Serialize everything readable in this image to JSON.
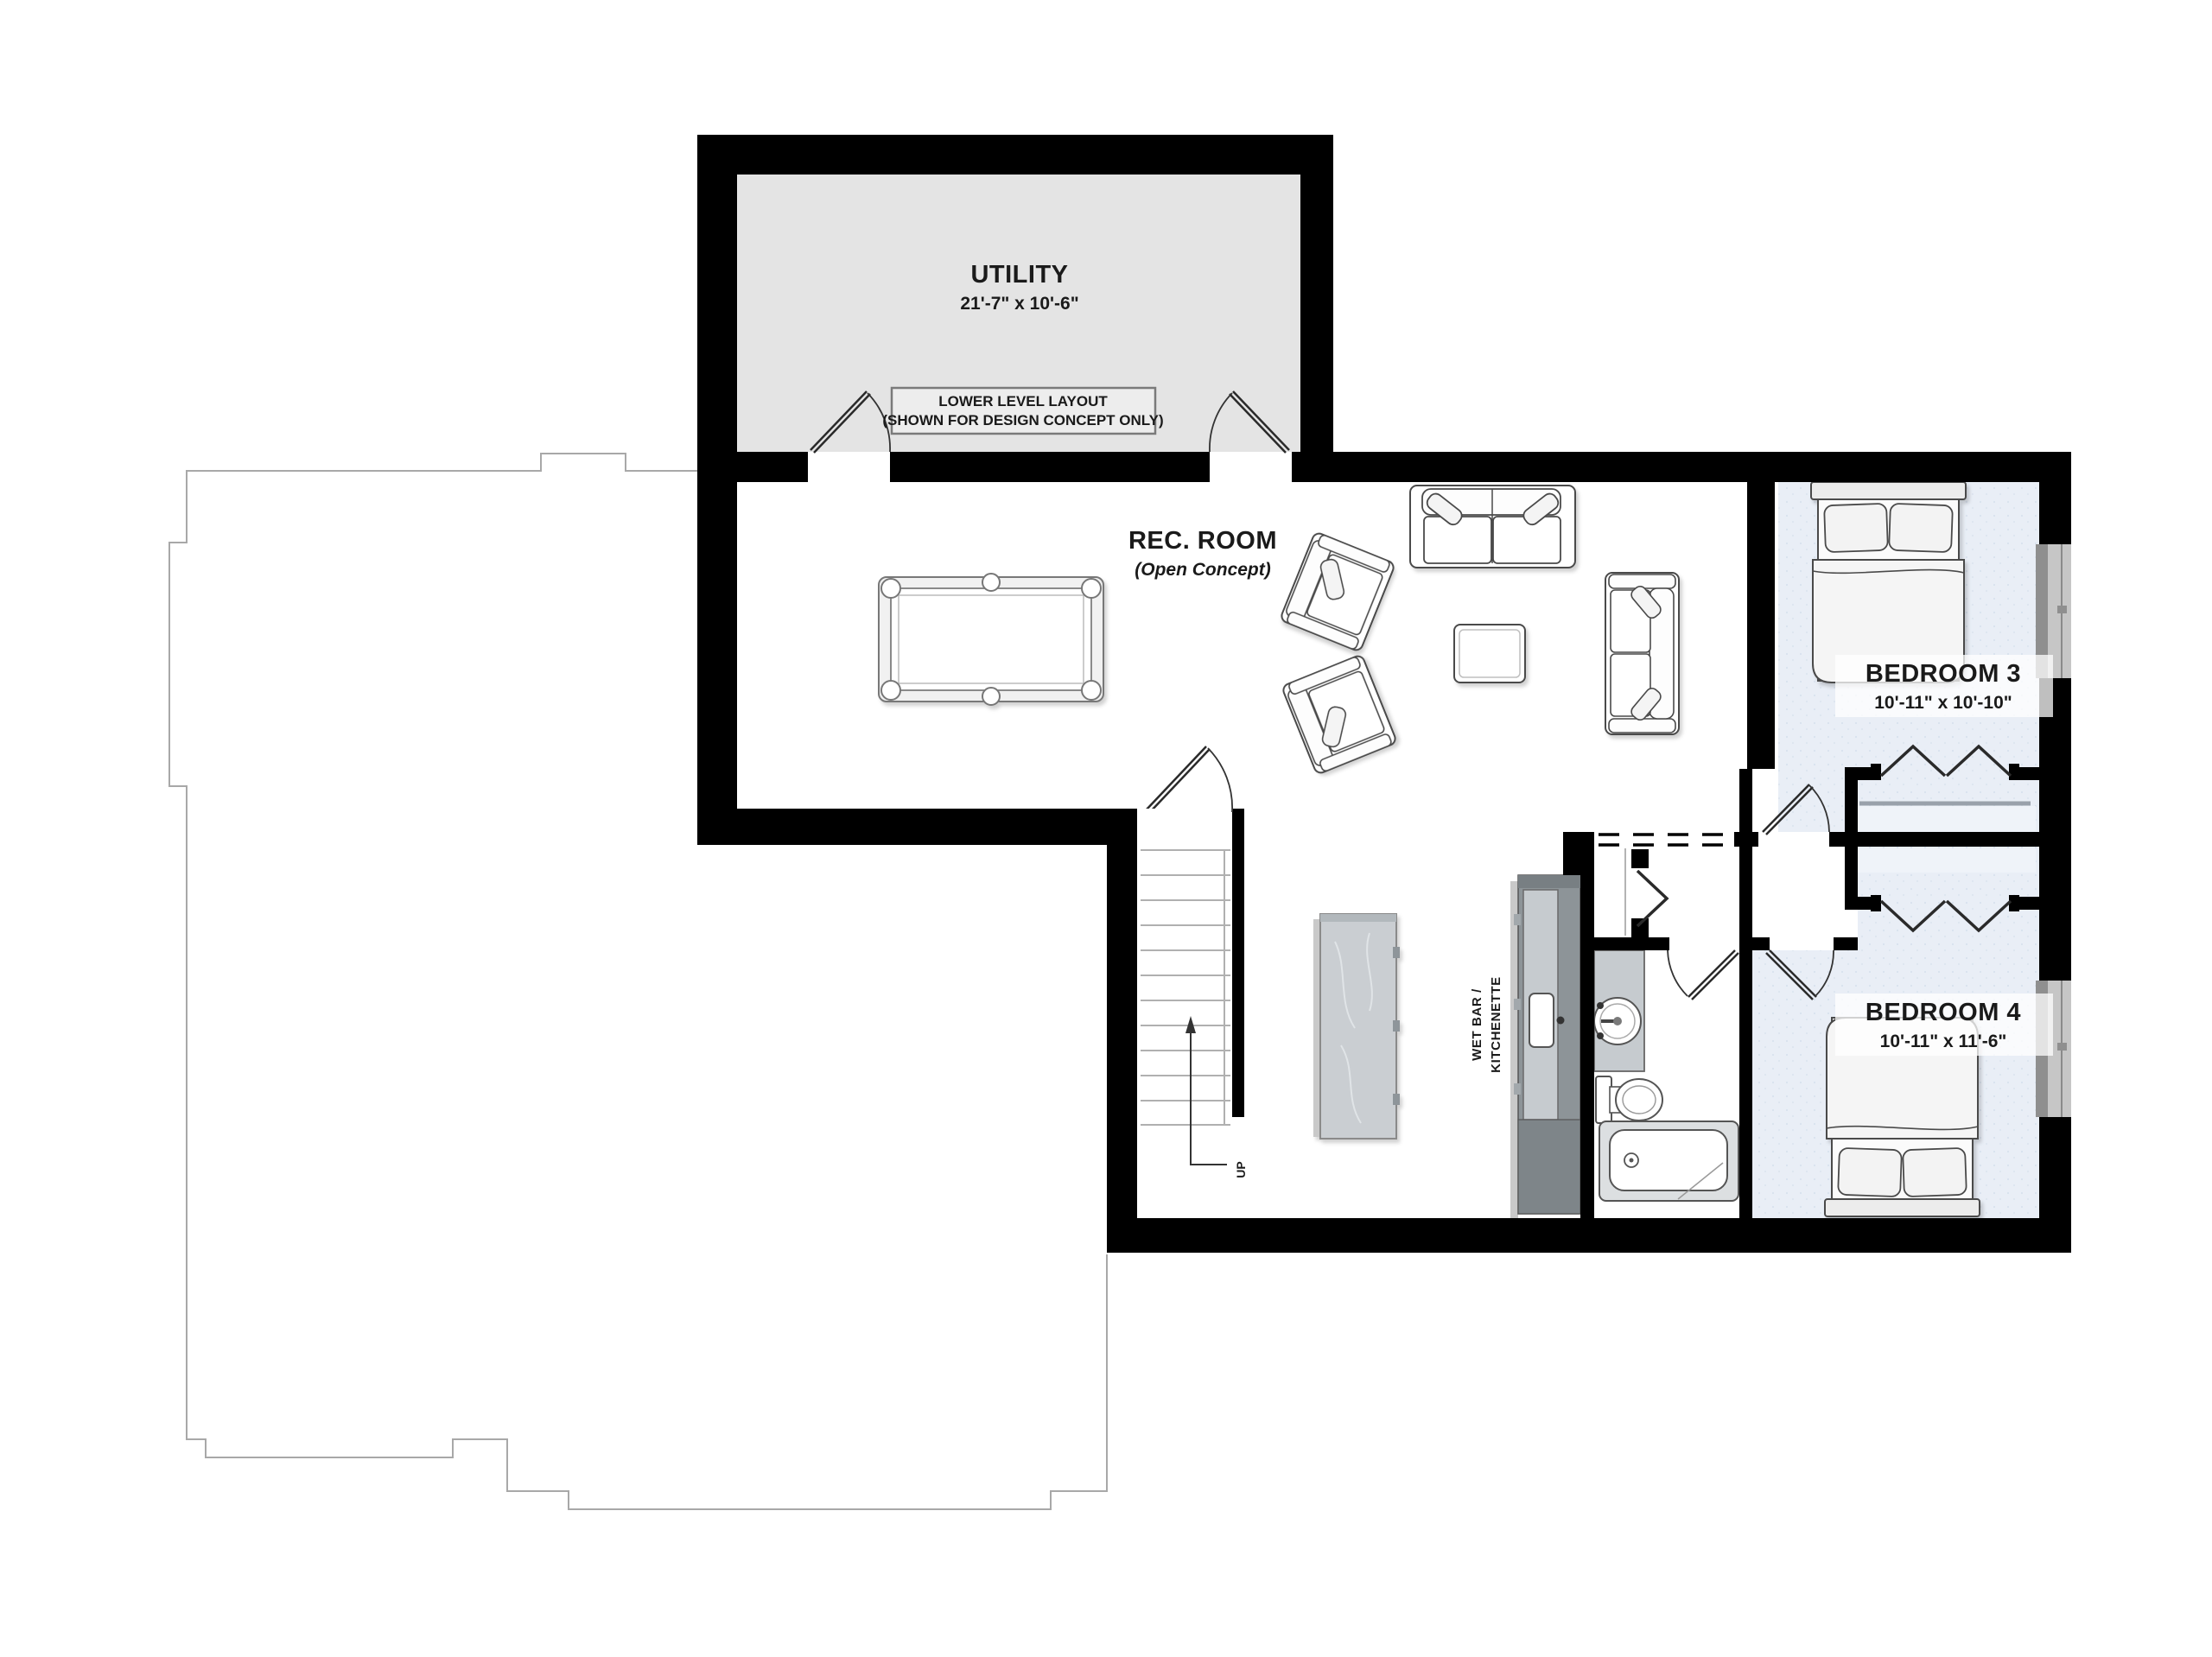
{
  "rooms": {
    "utility": {
      "name": "UTILITY",
      "dims": "21'-7\" x 10'-6\""
    },
    "rec_room": {
      "name": "REC. ROOM",
      "sub": "(Open Concept)"
    },
    "bedroom3": {
      "name": "BEDROOM 3",
      "dims": "10'-11\" x 10'-10\""
    },
    "bedroom4": {
      "name": "BEDROOM 4",
      "dims": "10'-11\" x 11'-6\""
    },
    "wet_bar": {
      "line1": "WET BAR /",
      "line2": "KITCHENETTE"
    }
  },
  "disclaimer": {
    "line1": "LOWER LEVEL LAYOUT",
    "line2": "(SHOWN FOR DESIGN CONCEPT ONLY)"
  },
  "stairs": {
    "label": "UP"
  },
  "colors": {
    "wall": "#000000",
    "utility_floor": "#e4e4e4",
    "disclaimer_fill": "#ededed",
    "bedroom_fill": "#e9eef6",
    "closet_band": "#eff3f9",
    "counter_dark": "#8d9498",
    "counter_cap": "#787f83",
    "counter_marble": "#c6cbcf",
    "island_marble": "#caced2",
    "window_frame": "#8f8f8f",
    "window_sill": "#c6c6c6",
    "outline_gray": "#a8a8a8",
    "text": "#1a1a1a"
  }
}
